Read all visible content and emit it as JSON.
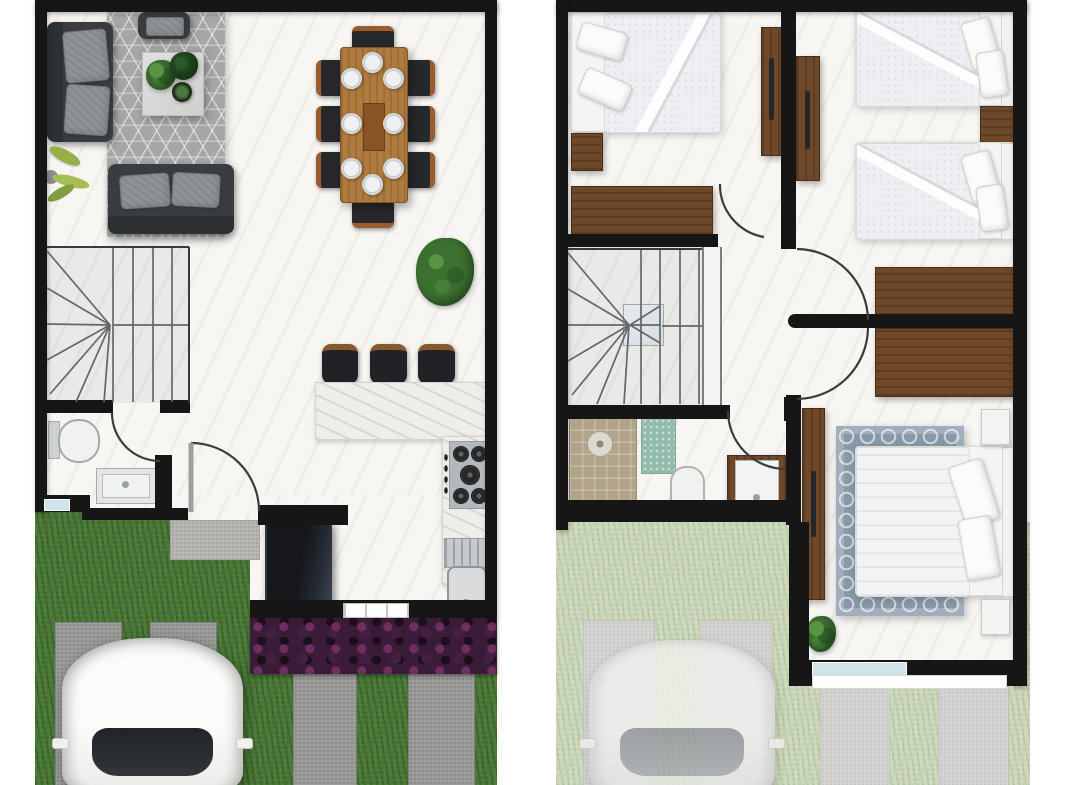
{
  "image": {
    "kind": "real-estate floor plan rendering, top-down view, two panels side by side",
    "panels": [
      {
        "id": "ground-floor",
        "label": "Ground floor plan",
        "features": [
          "living-room sofa set with gray geometric rug and coffee table with plants",
          "dining table with 8 chairs and 8 place settings",
          "winder staircase",
          "guest bathroom with toilet and sink",
          "entry door with swing arc",
          "L-shaped marble kitchen counter with 3 bar stools",
          "5-burner stove",
          "kitchen sink with drainboard",
          "refrigerator",
          "front lawn with concrete driveway strips",
          "white car parked",
          "purple flower hedge",
          "potted plant"
        ]
      },
      {
        "id": "upper-floor",
        "label": "Upper floor plan",
        "features": [
          "bedroom with double bed, nightstand, dresser and two wardrobes",
          "bedroom with two single beds and nightstand",
          "winder staircase with landing",
          "hallway with closets and door arcs",
          "bathroom with shower, bath mat, toilet and vanity sink",
          "master bedroom with king bed, blue trellis rug, wardrobe, nightstands and plant",
          "window with ledge",
          "faded view of driveway, lawn and car below"
        ]
      }
    ]
  },
  "colors": {
    "wall": "#161616",
    "floor": "#f7f6f3",
    "grass": "#4e7c3a",
    "grassPale": "#cfdabd",
    "paver": "#9c9c9a",
    "paverPale": "#d3d3d1",
    "wood": "#6e4828",
    "woodLight": "#b07b3f",
    "hedge": "#3a1c38",
    "rugGray": "#a6a6a6",
    "rugBlue": "#8798a8",
    "sofa": "#3a3d40",
    "counter": "#efedea",
    "showerTile": "#b2a489",
    "mat": "#93bbab",
    "bedding": "#edeff2",
    "accentWindow": "#cfe4ea"
  }
}
